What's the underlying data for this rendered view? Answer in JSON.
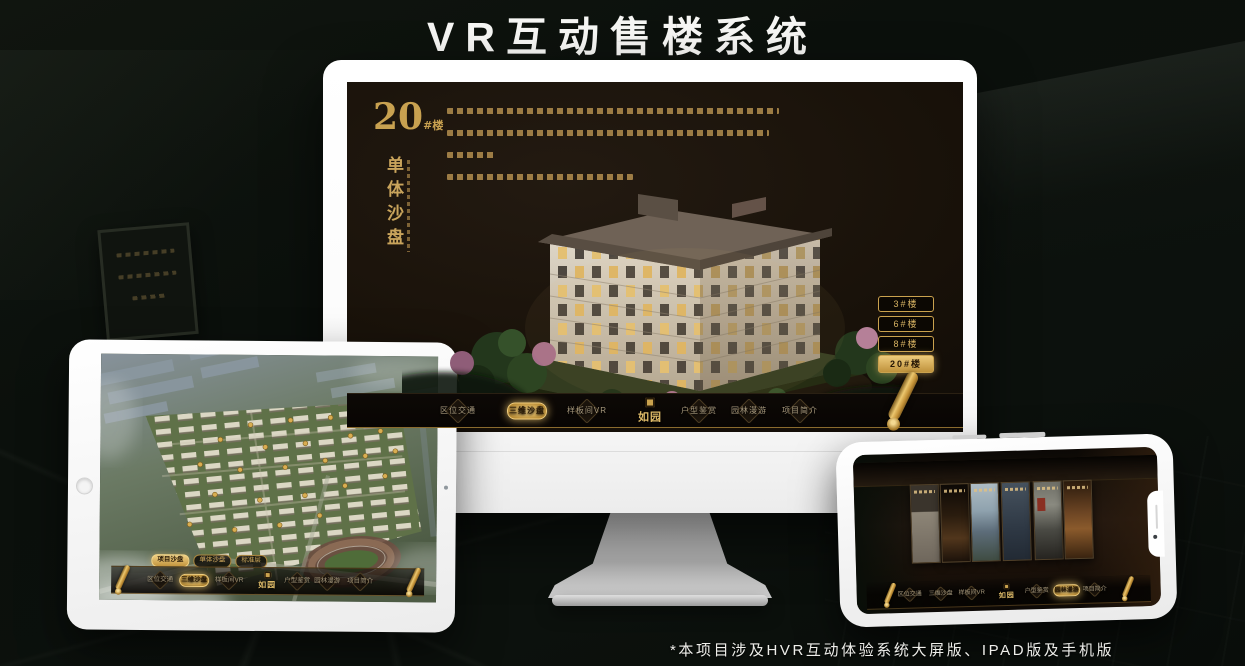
{
  "header": {
    "title": "VR互动售楼系统"
  },
  "footer": {
    "note": "*本项目涉及HVR互动体验系统大屏版、IPAD版及手机版"
  },
  "brand": {
    "name": "如园"
  },
  "colors": {
    "gold": "#c9a45c",
    "gold_bright": "#f0d084",
    "screen_bg": "#181109",
    "page_bg": "#0c110d"
  },
  "monitor": {
    "block": {
      "number": "20",
      "suffix": "#楼",
      "subtitle": "单体沙盘"
    },
    "floor_buttons": [
      {
        "label": "3#楼",
        "active": false
      },
      {
        "label": "6#楼",
        "active": false
      },
      {
        "label": "8#楼",
        "active": false
      },
      {
        "label": "20#楼",
        "active": true
      }
    ],
    "sub_tabs": [
      {
        "label": "项目沙盘",
        "active": false
      },
      {
        "label": "单体沙盘",
        "active": true
      },
      {
        "label": "标准层",
        "active": false
      }
    ],
    "nav_items": [
      {
        "label": "区位交通",
        "active": false
      },
      {
        "label": "三维沙盘",
        "active": true
      },
      {
        "label": "样板间VR",
        "active": false
      },
      {
        "label": "户型鉴赏",
        "active": false
      },
      {
        "label": "园林漫游",
        "active": false
      },
      {
        "label": "项目简介",
        "active": false
      }
    ]
  },
  "tablet": {
    "sub_tabs": [
      {
        "label": "项目沙盘",
        "active": true
      },
      {
        "label": "单体沙盘",
        "active": false
      },
      {
        "label": "标准层",
        "active": false
      }
    ],
    "nav_items": [
      {
        "label": "区位交通",
        "active": false
      },
      {
        "label": "三维沙盘",
        "active": true
      },
      {
        "label": "样板间VR",
        "active": false
      },
      {
        "label": "户型鉴赏",
        "active": false
      },
      {
        "label": "园林漫游",
        "active": false
      },
      {
        "label": "项目简介",
        "active": false
      }
    ]
  },
  "phone": {
    "nav_items": [
      {
        "label": "区位交通",
        "active": false
      },
      {
        "label": "三维沙盘",
        "active": false
      },
      {
        "label": "样板间VR",
        "active": false
      },
      {
        "label": "户型鉴赏",
        "active": false
      },
      {
        "label": "园林漫游",
        "active": true
      },
      {
        "label": "项目简介",
        "active": false
      }
    ]
  }
}
